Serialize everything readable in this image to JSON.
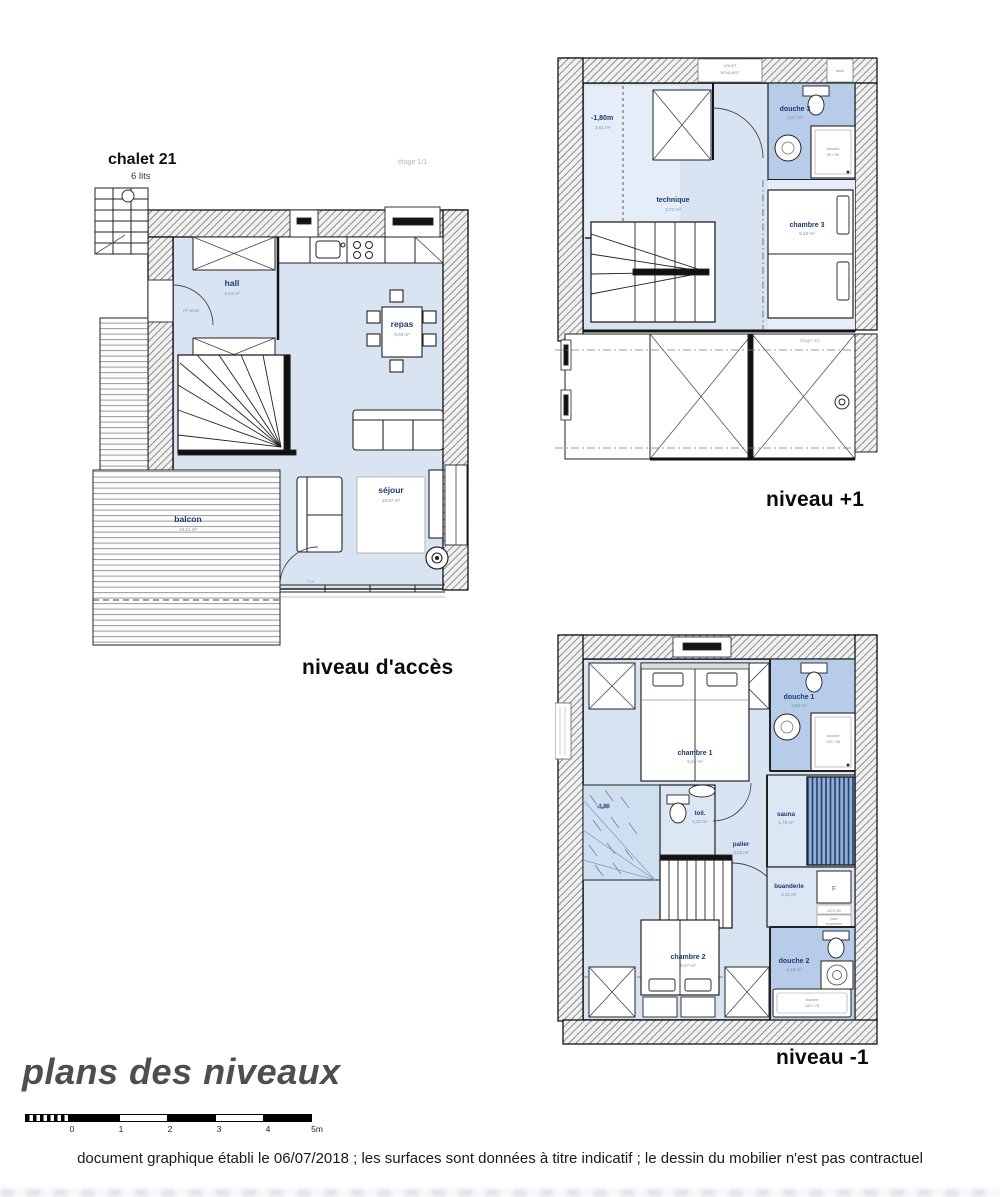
{
  "header": {
    "chalet": "chalet 21",
    "beds": "6 lits",
    "stage_note_access": "étage 1/1",
    "stage_note_plus1": "étage 3/3"
  },
  "plans": {
    "access": {
      "title": "niveau d'accès",
      "rooms": {
        "hall": {
          "name": "hall",
          "area": "4,34 m²"
        },
        "repas": {
          "name": "repas",
          "area": "9,03 m²"
        },
        "sejour": {
          "name": "séjour",
          "area": "18,97 m²"
        },
        "balcon": {
          "name": "balcon",
          "area": "19,21 m²"
        }
      },
      "annotations": {
        "door": "PF 90/90",
        "window": "fixe"
      }
    },
    "plus1": {
      "title": "niveau +1",
      "rooms": {
        "niche": {
          "name": "-1,80m",
          "area": "2,01 m²"
        },
        "technique": {
          "name": "technique",
          "area": "3,71 m²"
        },
        "douche3": {
          "name": "douche 3",
          "area": "2,97 m²"
        },
        "chambre3": {
          "name": "chambre 3",
          "area": "8,10 m²"
        }
      },
      "annotations": {
        "volet_line1": "VOLET",
        "volet_line2": "ROULANT",
        "seuil": "seuil",
        "shower_line1": "douche",
        "shower_line2": "90 / 90"
      }
    },
    "minus1": {
      "title": "niveau -1",
      "rooms": {
        "chambre1": {
          "name": "chambre 1",
          "area": "9,26 m²"
        },
        "douche1": {
          "name": "douche 1",
          "area": "3,50 m²"
        },
        "toilette": {
          "name": "toil.",
          "area": "1,32 m²"
        },
        "palier": {
          "name": "palier",
          "area": "2,53 m²"
        },
        "sauna": {
          "name": "sauna",
          "area": "1,78 m²"
        },
        "buanderie": {
          "name": "buanderie",
          "area": "2,31 m²"
        },
        "douche2": {
          "name": "douche 2",
          "area": "4,19 m²"
        },
        "chambre2": {
          "name": "chambre 2",
          "area": "9,47 m²"
        }
      },
      "annotations": {
        "height": "-1,80",
        "shower1_line1": "douche",
        "shower1_line2": "120 / 90",
        "shower2_line1": "douche",
        "shower2_line2": "160 / 75",
        "f_box": "F",
        "acv": "ACV 1B",
        "vase_line1": "vase",
        "vase_line2": "expansion"
      }
    }
  },
  "footer": {
    "main_title": "plans des niveaux",
    "note": "document graphique établi le 06/07/2018 ; les surfaces sont données à titre indicatif ; le dessin du mobilier n'est pas contractuel",
    "scale_ticks": [
      "0",
      "1",
      "2",
      "3",
      "4",
      "5m"
    ]
  }
}
